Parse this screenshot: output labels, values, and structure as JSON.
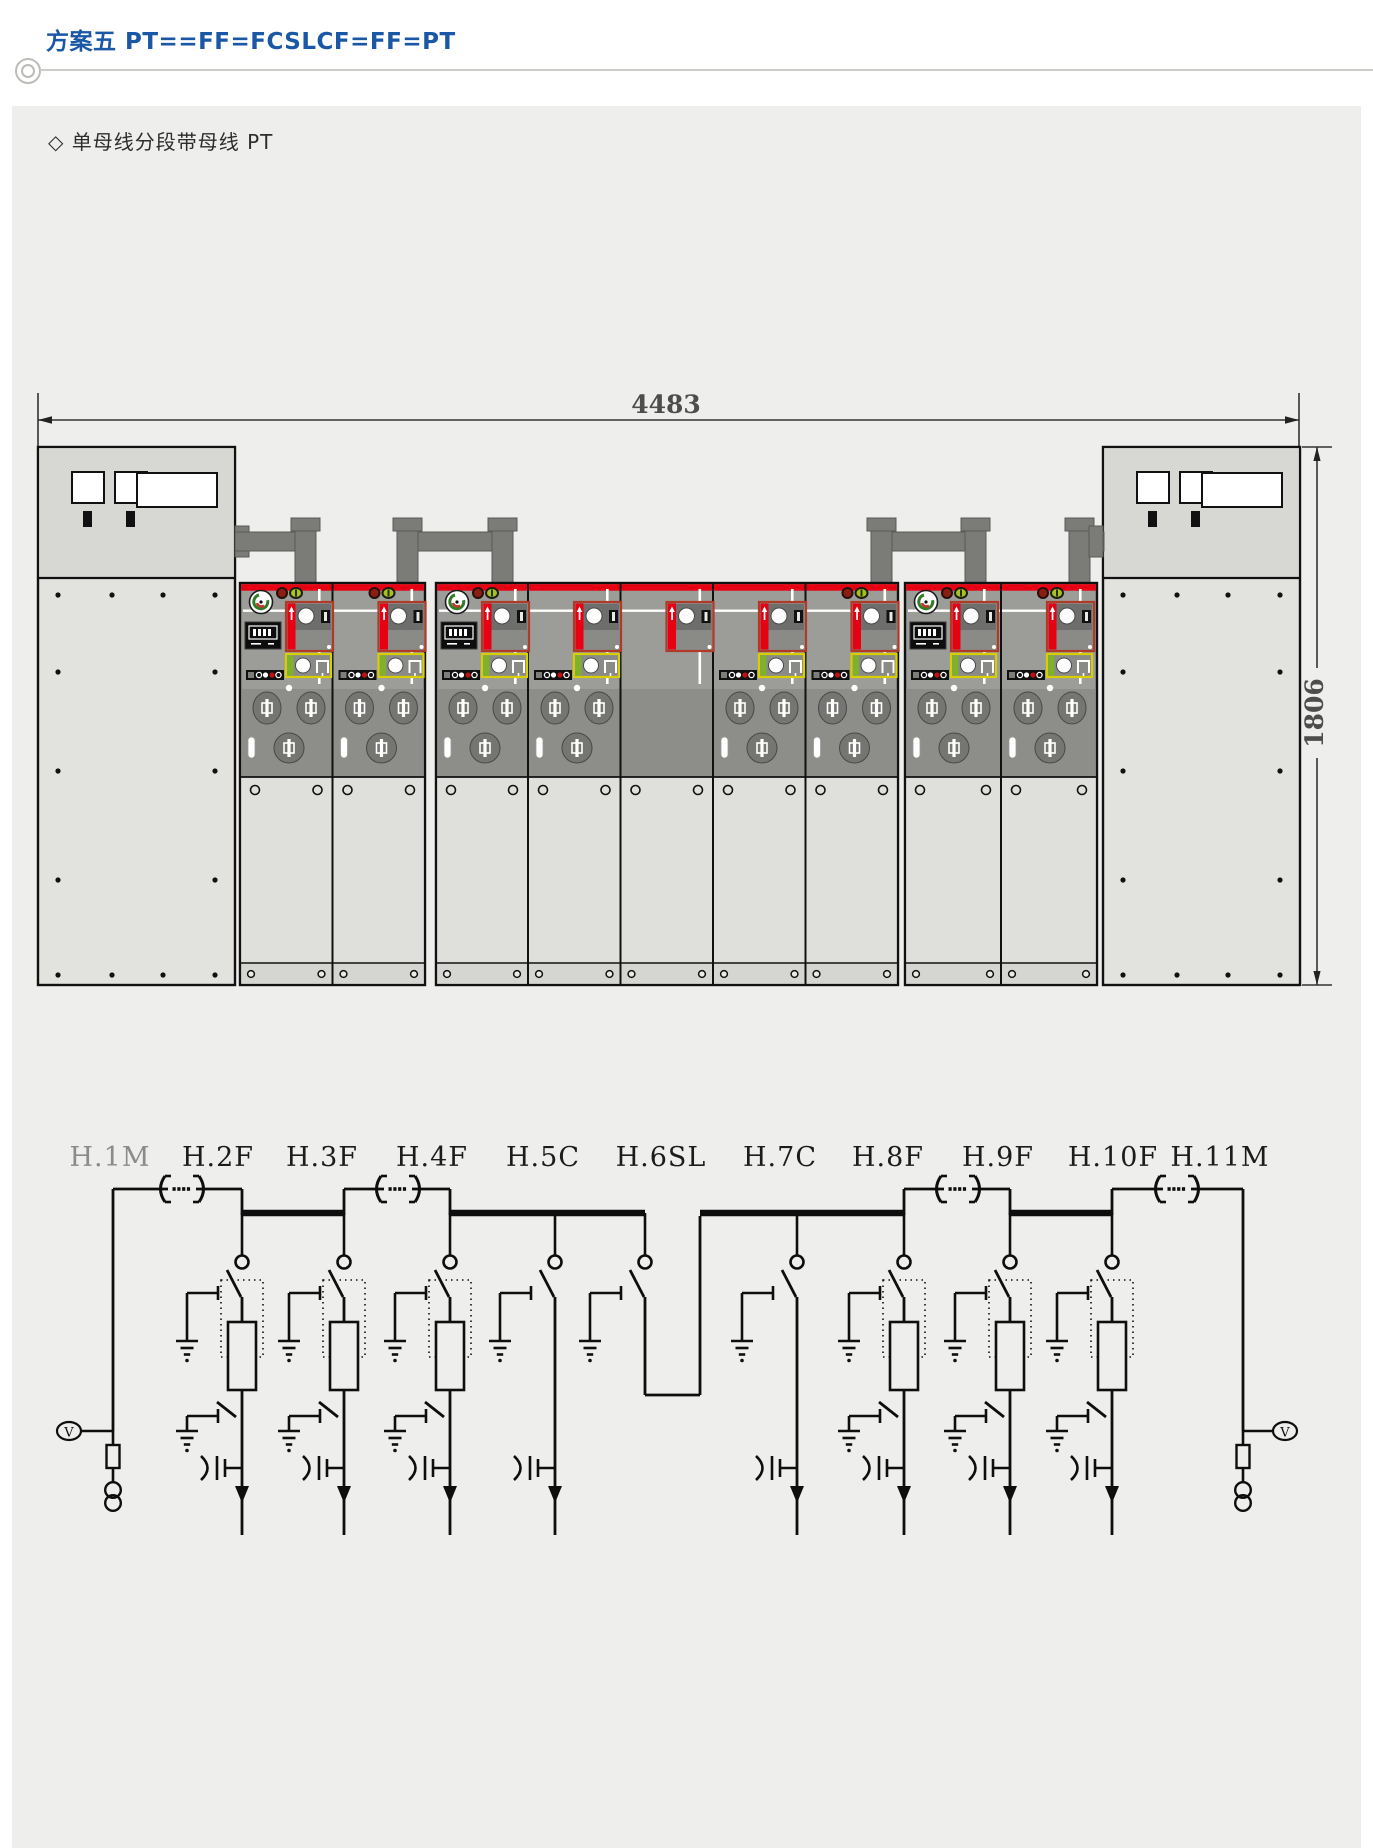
{
  "header": {
    "title": "方案五 PT==FF=FCSLCF=FF=PT"
  },
  "section": {
    "subtitle": "◇ 单母线分段带母线 PT"
  },
  "drawing": {
    "width_label": "4483",
    "height_label": "1806"
  },
  "schematic": {
    "voltage_indicator_label": "V",
    "units": [
      {
        "label": "H.1M",
        "code": "M",
        "position": "left-end"
      },
      {
        "label": "H.2F",
        "code": "F",
        "first_of_block": true
      },
      {
        "label": "H.3F",
        "code": "F"
      },
      {
        "label": "H.4F",
        "code": "F",
        "first_of_block": true
      },
      {
        "label": "H.5C",
        "code": "C"
      },
      {
        "label": "H.6SL",
        "code": "SL"
      },
      {
        "label": "H.7C",
        "code": "C"
      },
      {
        "label": "H.8F",
        "code": "F"
      },
      {
        "label": "H.9F",
        "code": "F",
        "first_of_block": true
      },
      {
        "label": "H.10F",
        "code": "F"
      },
      {
        "label": "H.11M",
        "code": "M",
        "position": "right-end"
      }
    ]
  },
  "colors": {
    "title_blue": "#1a57a5",
    "card": "#eeeeec",
    "busbar_red": "#e60012",
    "ink": "#0e0e0e",
    "dim_text": "#4d4d4d",
    "muted_label": "#8b8b8b",
    "busbar_bridge_gray": "#7b7b78"
  }
}
